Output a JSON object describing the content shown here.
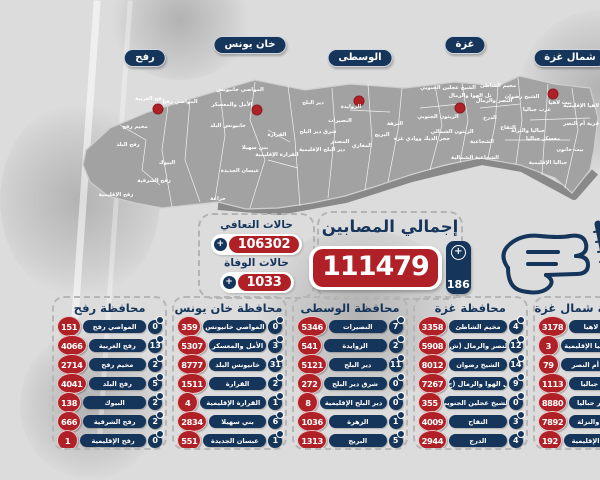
{
  "colors": {
    "red": "#b02127",
    "navy": "#16355b",
    "background": "#dcdcdc",
    "map_gray": "#a2a2a2",
    "map_shadow": "#6e6e6e"
  },
  "totals": {
    "infected_label": "إجمالي المصابين",
    "infected": "111479",
    "infected_new": "186",
    "recovered_label": "حالات التعافي",
    "recovered": "106302",
    "deaths_label": "حالات الوفاة",
    "deaths": "1033"
  },
  "pins": [
    {
      "name": "رفح",
      "total": "11777",
      "new": "24",
      "cx": 95,
      "cut": false,
      "dot": [
        108,
        109
      ]
    },
    {
      "name": "خان يونس",
      "total": "22389",
      "new": "52",
      "cx": 200,
      "cut": true,
      "dot": [
        207,
        110
      ]
    },
    {
      "name": "الوسطى",
      "total": "15128",
      "new": "27",
      "cx": 310,
      "cut": false,
      "dot": [
        309,
        101
      ]
    },
    {
      "name": "غزة",
      "total": "43914",
      "new": "65",
      "cx": 415,
      "cut": true,
      "dot": [
        410,
        108
      ]
    },
    {
      "name": "شمال غزة",
      "total": "18271",
      "new": "18",
      "cx": 520,
      "cut": false,
      "dot": [
        503,
        94
      ]
    }
  ],
  "governorates": [
    {
      "title": "محافظة رفح",
      "rows": [
        {
          "area": "المواصي رفح",
          "new": "0",
          "total": "151"
        },
        {
          "area": "رفح الغربية",
          "new": "13",
          "total": "4066"
        },
        {
          "area": "مخيم رفح",
          "new": "2",
          "total": "2714"
        },
        {
          "area": "رفح البلد",
          "new": "5",
          "total": "4041"
        },
        {
          "area": "البيوك",
          "new": "2",
          "total": "138"
        },
        {
          "area": "رفح الشرقية",
          "new": "2",
          "total": "666"
        },
        {
          "area": "رفح الإقليمية",
          "new": "0",
          "total": "1"
        }
      ]
    },
    {
      "title": "محافظة خان يونس",
      "rows": [
        {
          "area": "المواصي خانيونس",
          "new": "0",
          "total": "359"
        },
        {
          "area": "الأمل والمعسكر",
          "new": "3",
          "total": "5307"
        },
        {
          "area": "خانيونس البلد",
          "new": "31",
          "total": "8777"
        },
        {
          "area": "القرارة",
          "new": "2",
          "total": "1511"
        },
        {
          "area": "القرارة الإقليمية",
          "new": "1",
          "total": "4"
        },
        {
          "area": "بني سهيلا",
          "new": "6",
          "total": "2834"
        },
        {
          "area": "عبسان الجديدة",
          "new": "1",
          "total": "551"
        }
      ]
    },
    {
      "title": "محافظة الوسطى",
      "rows": [
        {
          "area": "النصيرات",
          "new": "7",
          "total": "5346"
        },
        {
          "area": "الزوايدة",
          "new": "2",
          "total": "541"
        },
        {
          "area": "دير البلح",
          "new": "11",
          "total": "5121"
        },
        {
          "area": "شرق دير البلح",
          "new": "0",
          "total": "272"
        },
        {
          "area": "دير البلح الإقليمية",
          "new": "0",
          "total": "8"
        },
        {
          "area": "الزهرة",
          "new": "1",
          "total": "1036"
        },
        {
          "area": "البريج",
          "new": "5",
          "total": "1313"
        }
      ]
    },
    {
      "title": "محافظة غزة",
      "rows": [
        {
          "area": "مخيم الشاطئ",
          "new": "4",
          "total": "3358"
        },
        {
          "area": "النصر والرمال (ش)",
          "new": "12",
          "total": "5908"
        },
        {
          "area": "الشيخ رضوان",
          "new": "14",
          "total": "8012"
        },
        {
          "area": "تل الهوا والرمال (ج)",
          "new": "9",
          "total": "7267"
        },
        {
          "area": "الشيخ عجلين الجنوبي",
          "new": "0",
          "total": "355"
        },
        {
          "area": "التفاح",
          "new": "3",
          "total": "4009"
        },
        {
          "area": "الدرج",
          "new": "4",
          "total": "2944"
        }
      ]
    },
    {
      "title": "محافظة شمال غزة",
      "rows": [
        {
          "area": "بيت لاهيا",
          "new": "11",
          "total": "3178"
        },
        {
          "area": "بيت لاهيا الإقليمية",
          "new": "0",
          "total": "3"
        },
        {
          "area": "قرية أم النصر",
          "new": "0",
          "total": "79"
        },
        {
          "area": "غرب جباليا",
          "new": "0",
          "total": "1113"
        },
        {
          "area": "معسكر جباليا",
          "new": "4",
          "total": "8880"
        },
        {
          "area": "جباليا والنزلة",
          "new": "0",
          "total": "7892"
        },
        {
          "area": "جباليا الإقليمية",
          "new": "0",
          "total": "192"
        }
      ]
    }
  ],
  "map_labels": [
    {
      "t": "رفح الغربية",
      "x": 100,
      "y": 100
    },
    {
      "t": "المواصي رفح",
      "x": 130,
      "y": 103
    },
    {
      "t": "مخيم رفح",
      "x": 85,
      "y": 128
    },
    {
      "t": "رفح البلد",
      "x": 78,
      "y": 146
    },
    {
      "t": "البيوك",
      "x": 117,
      "y": 164
    },
    {
      "t": "رفح الشرقية",
      "x": 104,
      "y": 182
    },
    {
      "t": "رفح الإقليمية",
      "x": 66,
      "y": 196
    },
    {
      "t": "المواصي خانيونس",
      "x": 190,
      "y": 91
    },
    {
      "t": "الأمل والمعسكر",
      "x": 182,
      "y": 106
    },
    {
      "t": "خانيونس البلد",
      "x": 178,
      "y": 127
    },
    {
      "t": "القرارة",
      "x": 227,
      "y": 136
    },
    {
      "t": "بني سهيلا",
      "x": 205,
      "y": 149
    },
    {
      "t": "القرارة الإقليمية",
      "x": 227,
      "y": 156
    },
    {
      "t": "عبسان الجديدة",
      "x": 190,
      "y": 172
    },
    {
      "t": "خزاعة",
      "x": 168,
      "y": 200
    },
    {
      "t": "دير البلح",
      "x": 263,
      "y": 104
    },
    {
      "t": "الزوايدة",
      "x": 301,
      "y": 108
    },
    {
      "t": "شرق دير البلح",
      "x": 268,
      "y": 133
    },
    {
      "t": "المصدر",
      "x": 290,
      "y": 143
    },
    {
      "t": "دير البلح الإقليمية",
      "x": 272,
      "y": 151
    },
    {
      "t": "النصيرات",
      "x": 290,
      "y": 122
    },
    {
      "t": "المغازي",
      "x": 312,
      "y": 147
    },
    {
      "t": "النزهة",
      "x": 345,
      "y": 125
    },
    {
      "t": "البريج",
      "x": 332,
      "y": 136
    },
    {
      "t": "جحر الديك ووادي غزة",
      "x": 372,
      "y": 140
    },
    {
      "t": "الشيخ عجلين الجنوبي",
      "x": 398,
      "y": 89
    },
    {
      "t": "تل الهوا والرمال",
      "x": 420,
      "y": 97
    },
    {
      "t": "مخيم الشاطئ",
      "x": 448,
      "y": 87
    },
    {
      "t": "النصر والرمال",
      "x": 444,
      "y": 102
    },
    {
      "t": "الشيخ رضوان",
      "x": 472,
      "y": 98
    },
    {
      "t": "الزيتون الجنوبي",
      "x": 388,
      "y": 118
    },
    {
      "t": "الزيتون الشمالي",
      "x": 402,
      "y": 133
    },
    {
      "t": "الدرج",
      "x": 440,
      "y": 119
    },
    {
      "t": "التفاح",
      "x": 458,
      "y": 129
    },
    {
      "t": "الشجاعية",
      "x": 432,
      "y": 143
    },
    {
      "t": "الشجاعية الشمالية",
      "x": 425,
      "y": 159
    },
    {
      "t": "بيت لاهيا",
      "x": 510,
      "y": 104
    },
    {
      "t": "بيت لاهيا الإقليمية",
      "x": 537,
      "y": 107
    },
    {
      "t": "قرية أم النصر",
      "x": 531,
      "y": 125
    },
    {
      "t": "غرب جباليا",
      "x": 487,
      "y": 111
    },
    {
      "t": "جباليا والنزلة",
      "x": 478,
      "y": 132
    },
    {
      "t": "معسكر جباليا",
      "x": 493,
      "y": 140
    },
    {
      "t": "بيت حانون",
      "x": 520,
      "y": 151
    },
    {
      "t": "جباليا الإقليمية",
      "x": 498,
      "y": 164
    }
  ],
  "chart_data": {
    "type": "table",
    "title": "إجمالي المصابين",
    "total_infected": 111479,
    "new_infected": 186,
    "recovered": 106302,
    "deaths": 1033,
    "governorates": [
      {
        "name": "رفح",
        "total": 11777,
        "new": 24,
        "areas": [
          [
            "المواصي رفح",
            0,
            151
          ],
          [
            "رفح الغربية",
            13,
            4066
          ],
          [
            "مخيم رفح",
            2,
            2714
          ],
          [
            "رفح البلد",
            5,
            4041
          ],
          [
            "البيوك",
            2,
            138
          ],
          [
            "رفح الشرقية",
            2,
            666
          ],
          [
            "رفح الإقليمية",
            0,
            1
          ]
        ]
      },
      {
        "name": "خان يونس",
        "total": 22389,
        "new": 52,
        "areas": [
          [
            "المواصي خانيونس",
            0,
            359
          ],
          [
            "الأمل والمعسكر",
            3,
            5307
          ],
          [
            "خانيونس البلد",
            31,
            8777
          ],
          [
            "القرارة",
            2,
            1511
          ],
          [
            "القرارة الإقليمية",
            1,
            4
          ],
          [
            "بني سهيلا",
            6,
            2834
          ],
          [
            "عبسان الجديدة",
            1,
            551
          ]
        ]
      },
      {
        "name": "الوسطى",
        "total": 15128,
        "new": 27,
        "areas": [
          [
            "النصيرات",
            7,
            5346
          ],
          [
            "الزوايدة",
            2,
            541
          ],
          [
            "دير البلح",
            11,
            5121
          ],
          [
            "شرق دير البلح",
            0,
            272
          ],
          [
            "دير البلح الإقليمية",
            0,
            8
          ],
          [
            "الزهرة",
            1,
            1036
          ],
          [
            "البريج",
            5,
            1313
          ]
        ]
      },
      {
        "name": "غزة",
        "total": 43914,
        "new": 65,
        "areas": [
          [
            "مخيم الشاطئ",
            4,
            3358
          ],
          [
            "النصر والرمال (ش)",
            12,
            5908
          ],
          [
            "الشيخ رضوان",
            14,
            8012
          ],
          [
            "تل الهوا والرمال (ج)",
            9,
            7267
          ],
          [
            "الشيخ عجلين الجنوبي",
            0,
            355
          ],
          [
            "التفاح",
            3,
            4009
          ],
          [
            "الدرج",
            4,
            2944
          ]
        ]
      },
      {
        "name": "شمال غزة",
        "total": 18271,
        "new": 18,
        "areas": [
          [
            "بيت لاهيا",
            11,
            3178
          ],
          [
            "بيت لاهيا الإقليمية",
            0,
            3
          ],
          [
            "قرية أم النصر",
            0,
            79
          ],
          [
            "غرب جباليا",
            0,
            1113
          ],
          [
            "معسكر جباليا",
            4,
            8880
          ],
          [
            "جباليا والنزلة",
            0,
            7892
          ],
          [
            "جباليا الإقليمية",
            0,
            192
          ]
        ]
      }
    ]
  }
}
